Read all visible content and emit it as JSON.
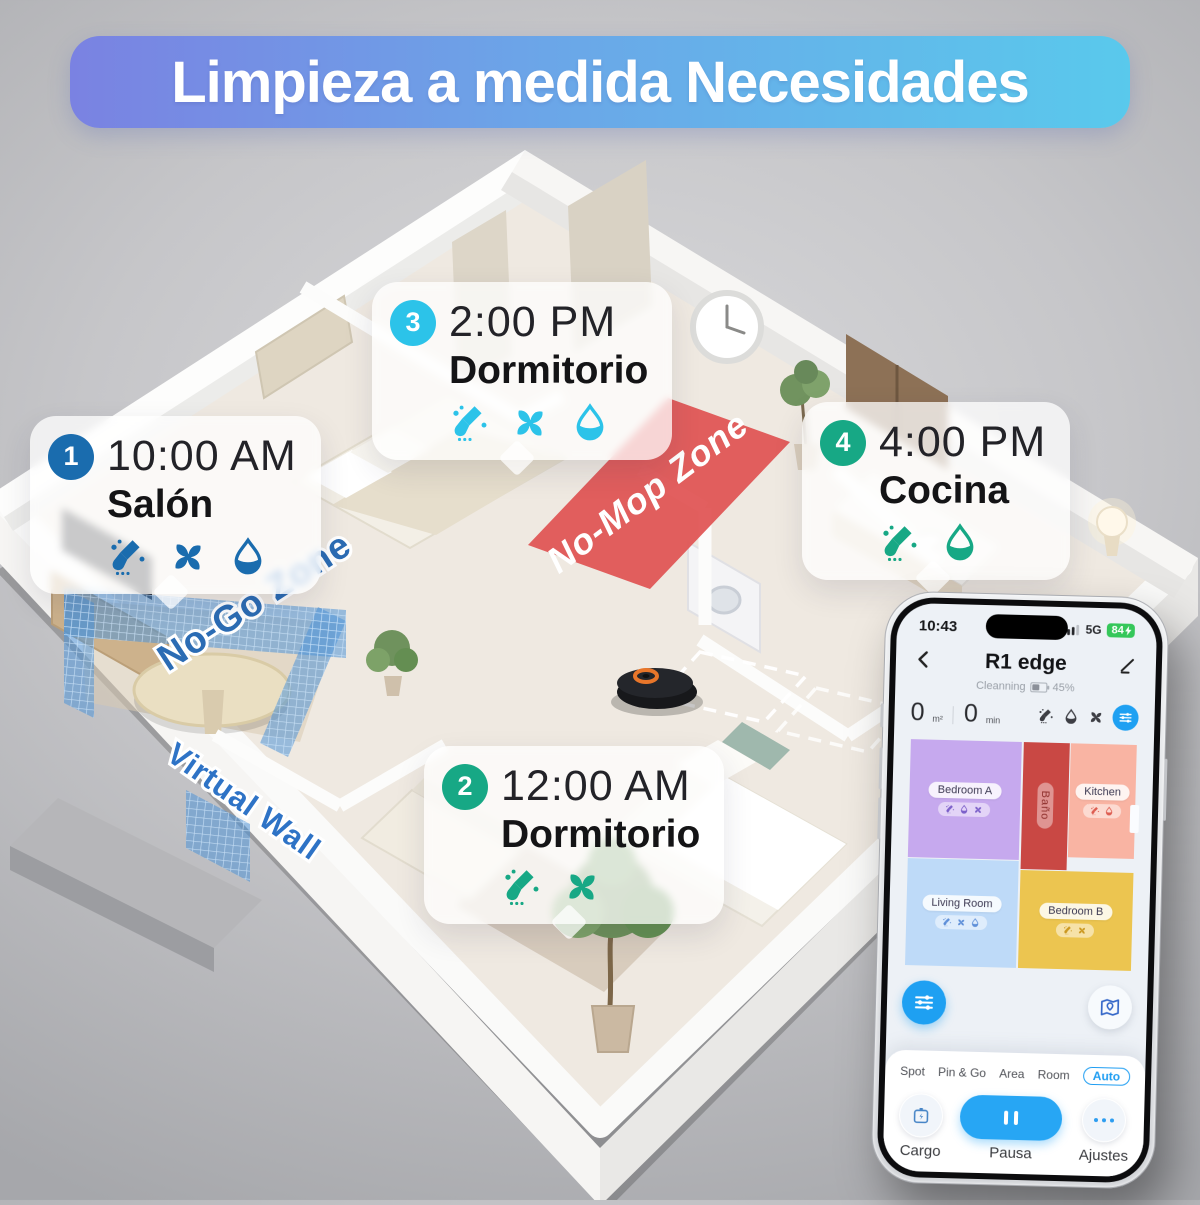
{
  "banner": {
    "title": "Limpieza a medida Necesidades"
  },
  "colors": {
    "banner_gradient_left": "#7a82e2",
    "banner_gradient_right": "#59c9ec",
    "accent_blue": "#1a6cae",
    "accent_cyan": "#2cc3e9",
    "accent_green": "#17a885",
    "no_mop_zone_red": "#e05353",
    "no_go_zone_blue": "#4f93d6",
    "phone_accent_blue": "#1ea0f2",
    "battery_green": "#35c75a",
    "room_bedroom_a": "#c6a9ee",
    "room_bano": "#c94844",
    "room_kitchen": "#f9b4a3",
    "room_living": "#bedaf8",
    "room_bedroom_b": "#ecc550"
  },
  "callouts": [
    {
      "num": "1",
      "time": "10:00 AM",
      "room": "Salón",
      "icons": [
        "mop-icon",
        "fan-icon",
        "drop-icon"
      ]
    },
    {
      "num": "2",
      "time": "12:00 AM",
      "room": "Dormitorio",
      "icons": [
        "mop-icon",
        "fan-icon"
      ]
    },
    {
      "num": "3",
      "time": "2:00 PM",
      "room": "Dormitorio",
      "icons": [
        "mop-icon",
        "fan-icon",
        "drop-icon"
      ]
    },
    {
      "num": "4",
      "time": "4:00 PM",
      "room": "Cocina",
      "icons": [
        "mop-icon",
        "drop-icon"
      ]
    }
  ],
  "zones": {
    "no_mop": "No-Mop Zone",
    "no_go": "No-Go Zone",
    "virtual_wall": "Virtual Wall"
  },
  "phone": {
    "status": {
      "time": "10:43",
      "network": "5G",
      "battery": "84"
    },
    "nav": {
      "title": "R1 edge"
    },
    "state": {
      "label": "Cleanning",
      "battery": "45%"
    },
    "stats": {
      "area_value": "0",
      "area_unit": "m²",
      "time_value": "0",
      "time_unit": "min"
    },
    "map": {
      "rooms": [
        {
          "name": "Bedroom A",
          "icons": [
            "mop-icon",
            "drop-icon",
            "fan-icon"
          ]
        },
        {
          "name": "Baño",
          "icons": []
        },
        {
          "name": "Kitchen",
          "icons": [
            "mop-icon",
            "drop-icon"
          ]
        },
        {
          "name": "Living Room",
          "icons": [
            "mop-icon",
            "fan-icon",
            "drop-icon"
          ]
        },
        {
          "name": "Bedroom B",
          "icons": [
            "mop-icon",
            "fan-icon"
          ]
        }
      ]
    },
    "modes": {
      "items": [
        "Spot",
        "Pin & Go",
        "Area",
        "Room"
      ],
      "active": "Auto"
    },
    "controls": {
      "left": "Cargo",
      "center": "Pausa",
      "right": "Ajustes"
    }
  }
}
